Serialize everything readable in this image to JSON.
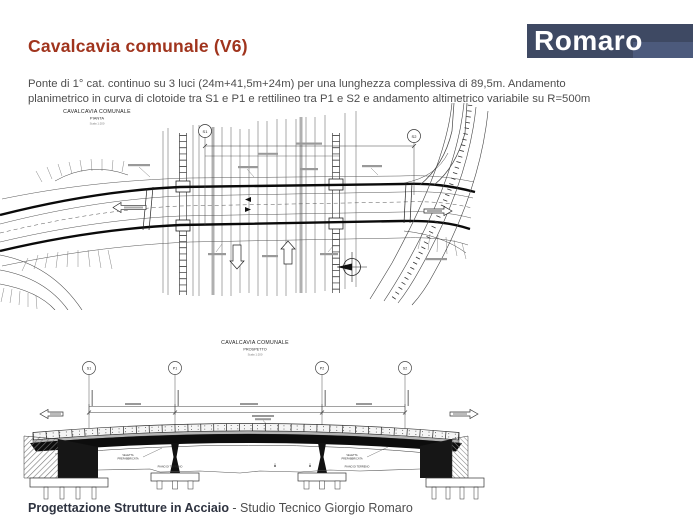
{
  "colors": {
    "title_accent": "#a0341d",
    "logo_background": "#3e4963",
    "logo_foreground": "#ffffff",
    "body_text": "#4e4e4e",
    "footer_bold": "#2e3340",
    "drawing_ink": "#222222"
  },
  "header": {
    "title": "Cavalcavia comunale (V6)",
    "logo_text": "Romaro",
    "description_line1": "Ponte di 1° cat. continuo su 3 luci (24m+41,5m+24m) per una lunghezza complessiva di 89,5m. Andamento",
    "description_line2": "planimetrico in curva di clotoide tra S1 e P1 e rettilineo tra P1 e S2 e andamento altimetrico variabile su R=500m"
  },
  "plan": {
    "title": "CAVALCAVIA COMUNALE",
    "subtitle": "PIANTA",
    "scale": "Scala 1:200",
    "marker_start": "S1",
    "marker_end": "S2"
  },
  "elevation": {
    "title": "CAVALCAVIA COMUNALE",
    "subtitle": "PROSPETTO",
    "scale": "Scala 1:200",
    "markers": [
      "S1",
      "P1",
      "P2",
      "S2"
    ],
    "label_veletta_1": "VELETTA",
    "label_veletta_2": "PREFABBRICATA",
    "label_ground": "PIANO DI TERRENO"
  },
  "footer": {
    "bold_text": "Progettazione Strutture in Acciaio",
    "regular_text": " - Studio Tecnico Giorgio Romaro"
  }
}
